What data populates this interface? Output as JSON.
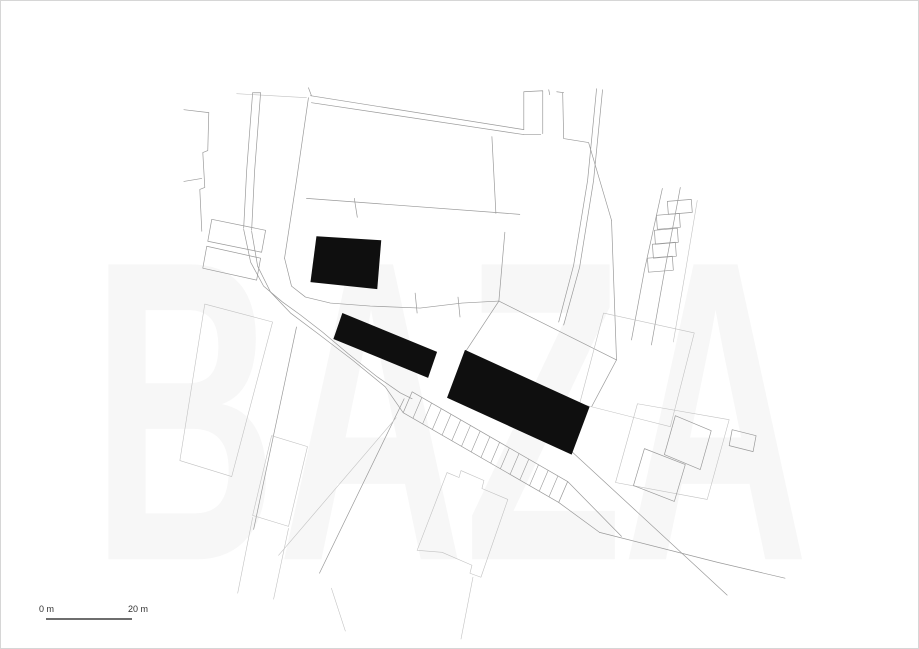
{
  "page": {
    "background": "#ffffff",
    "border_color": "#d6d6d6"
  },
  "watermark": {
    "text": "BAZA",
    "color": "#f7f7f7"
  },
  "scale_bar": {
    "start_label": "0 m",
    "end_label": "20 m",
    "line_color": "#6e6e6e",
    "text_color": "#333333"
  },
  "plan": {
    "canvas": {
      "width": 919,
      "height": 649
    },
    "colors": {
      "line_medium": "#9a9a9a",
      "line_light": "#c2c2c2",
      "building_fill": "#0f0f0f"
    },
    "buildings": [
      {
        "name": "building-footprint-top",
        "pts": [
          [
            316,
            236
          ],
          [
            381,
            240
          ],
          [
            377,
            289
          ],
          [
            310,
            282
          ]
        ]
      },
      {
        "name": "building-footprint-middle",
        "pts": [
          [
            342,
            313
          ],
          [
            437,
            352
          ],
          [
            428,
            378
          ],
          [
            333,
            339
          ]
        ]
      },
      {
        "name": "building-footprint-large",
        "pts": [
          [
            465,
            350
          ],
          [
            590,
            407
          ],
          [
            572,
            455
          ],
          [
            447,
            398
          ]
        ]
      }
    ],
    "parking_strip": {
      "outline": [
        [
          412,
          392
        ],
        [
          568,
          482
        ],
        [
          559,
          503
        ],
        [
          403,
          413
        ]
      ],
      "divider_count": 16
    },
    "polygons": [
      {
        "name": "small-parcel-1",
        "w": "m",
        "pts": [
          [
            211,
            219
          ],
          [
            265,
            230
          ],
          [
            261,
            252
          ],
          [
            207,
            241
          ]
        ]
      },
      {
        "name": "small-parcel-2",
        "w": "m",
        "pts": [
          [
            206,
            246
          ],
          [
            260,
            258
          ],
          [
            256,
            280
          ],
          [
            202,
            268
          ]
        ]
      },
      {
        "name": "garage-1",
        "w": "m",
        "pts": [
          [
            668,
            201
          ],
          [
            692,
            199
          ],
          [
            693,
            212
          ],
          [
            669,
            214
          ]
        ]
      },
      {
        "name": "garage-2",
        "w": "m",
        "pts": [
          [
            657,
            215
          ],
          [
            680,
            213
          ],
          [
            681,
            227
          ],
          [
            658,
            229
          ]
        ]
      },
      {
        "name": "garage-3",
        "w": "m",
        "pts": [
          [
            655,
            230
          ],
          [
            678,
            228
          ],
          [
            679,
            242
          ],
          [
            656,
            244
          ]
        ]
      },
      {
        "name": "garage-4",
        "w": "m",
        "pts": [
          [
            653,
            244
          ],
          [
            676,
            242
          ],
          [
            677,
            256
          ],
          [
            654,
            258
          ]
        ]
      },
      {
        "name": "garage-5",
        "w": "m",
        "pts": [
          [
            648,
            258
          ],
          [
            673,
            256
          ],
          [
            674,
            270
          ],
          [
            649,
            272
          ]
        ]
      },
      {
        "name": "west-parcel",
        "w": "l",
        "pts": [
          [
            204,
            304
          ],
          [
            272,
            322
          ],
          [
            231,
            477
          ],
          [
            179,
            461
          ]
        ]
      },
      {
        "name": "west-narrow-parcel",
        "w": "l",
        "pts": [
          [
            271,
            436
          ],
          [
            307,
            447
          ],
          [
            288,
            527
          ],
          [
            252,
            516
          ]
        ]
      },
      {
        "name": "southeast-parcel-1",
        "w": "l",
        "pts": [
          [
            604,
            313
          ],
          [
            695,
            333
          ],
          [
            671,
            427
          ],
          [
            580,
            404
          ]
        ]
      },
      {
        "name": "southeast-parcel-2",
        "w": "l",
        "pts": [
          [
            638,
            404
          ],
          [
            730,
            420
          ],
          [
            708,
            500
          ],
          [
            616,
            483
          ]
        ]
      },
      {
        "name": "southeast-inner-square-1",
        "w": "m",
        "pts": [
          [
            676,
            416
          ],
          [
            712,
            431
          ],
          [
            701,
            470
          ],
          [
            665,
            455
          ]
        ]
      },
      {
        "name": "southeast-inner-square-2",
        "w": "m",
        "pts": [
          [
            645,
            449
          ],
          [
            686,
            465
          ],
          [
            675,
            502
          ],
          [
            634,
            486
          ]
        ]
      },
      {
        "name": "southeast-appendage",
        "w": "m",
        "pts": [
          [
            733,
            430
          ],
          [
            757,
            436
          ],
          [
            754,
            452
          ],
          [
            730,
            446
          ]
        ]
      },
      {
        "name": "south-building-outline",
        "w": "l",
        "pts": [
          [
            447,
            473
          ],
          [
            459,
            478
          ],
          [
            461,
            471
          ],
          [
            484,
            481
          ],
          [
            482,
            489
          ],
          [
            508,
            500
          ],
          [
            481,
            578
          ],
          [
            470,
            574
          ],
          [
            472,
            566
          ],
          [
            442,
            553
          ],
          [
            417,
            551
          ]
        ]
      }
    ],
    "polylines": [
      {
        "name": "north-wall-band-top",
        "w": "m",
        "pts": [
          [
            310,
            95
          ],
          [
            524,
            129
          ]
        ]
      },
      {
        "name": "north-wall-band-bottom",
        "w": "m",
        "pts": [
          [
            311,
            102
          ],
          [
            524,
            134
          ]
        ]
      },
      {
        "name": "band-left-tick",
        "w": "m",
        "pts": [
          [
            308,
            87
          ],
          [
            311,
            95
          ]
        ]
      },
      {
        "name": "band-right-step",
        "w": "m",
        "pts": [
          [
            524,
            129
          ],
          [
            524,
            91
          ],
          [
            543,
            90
          ],
          [
            543,
            133
          ]
        ]
      },
      {
        "name": "band-bottom-stub",
        "w": "m",
        "pts": [
          [
            524,
            134
          ],
          [
            541,
            134
          ]
        ]
      },
      {
        "name": "band-tick-2",
        "w": "m",
        "pts": [
          [
            549,
            89
          ],
          [
            550,
            94
          ]
        ]
      },
      {
        "name": "band-tick-3",
        "w": "m",
        "pts": [
          [
            557,
            91
          ],
          [
            564,
            92
          ]
        ]
      },
      {
        "name": "band-right-outline",
        "w": "m",
        "pts": [
          [
            563,
            92
          ],
          [
            564,
            138
          ],
          [
            589,
            142
          ],
          [
            612,
            220
          ]
        ]
      },
      {
        "name": "parcel-east-edge",
        "w": "m",
        "pts": [
          [
            612,
            220
          ],
          [
            617,
            360
          ]
        ]
      },
      {
        "name": "top-connector",
        "w": "l",
        "pts": [
          [
            236,
            93
          ],
          [
            306,
            97
          ]
        ]
      },
      {
        "name": "parcel-divider",
        "w": "m",
        "pts": [
          [
            306,
            198
          ],
          [
            520,
            214
          ]
        ]
      },
      {
        "name": "parcel-vertical-divider",
        "w": "m",
        "pts": [
          [
            492,
            136
          ],
          [
            496,
            213
          ]
        ]
      },
      {
        "name": "parcel-vertical-tick",
        "w": "m",
        "pts": [
          [
            354,
            198
          ],
          [
            357,
            217
          ]
        ]
      },
      {
        "name": "west-jagged-edge",
        "w": "m",
        "pts": [
          [
            208,
            112
          ],
          [
            207,
            150
          ],
          [
            202,
            152
          ],
          [
            204,
            187
          ],
          [
            199,
            189
          ],
          [
            201,
            231
          ]
        ]
      },
      {
        "name": "west-stub-1",
        "w": "m",
        "pts": [
          [
            183,
            109
          ],
          [
            208,
            112
          ]
        ]
      },
      {
        "name": "west-stub-2",
        "w": "m",
        "pts": [
          [
            183,
            181
          ],
          [
            201,
            178
          ]
        ]
      },
      {
        "name": "west-road-line-1",
        "w": "m",
        "pts": [
          [
            252,
            92
          ],
          [
            246,
            170
          ],
          [
            243,
            228
          ]
        ]
      },
      {
        "name": "west-road-line-2",
        "w": "m",
        "pts": [
          [
            260,
            92
          ],
          [
            254,
            170
          ],
          [
            251,
            230
          ]
        ]
      },
      {
        "name": "west-road-top-tick",
        "w": "m",
        "pts": [
          [
            252,
            92
          ],
          [
            260,
            92
          ]
        ]
      },
      {
        "name": "street-outer-edge",
        "w": "m",
        "pts": [
          [
            251,
            231
          ],
          [
            257,
            266
          ],
          [
            270,
            292
          ],
          [
            290,
            313
          ],
          [
            318,
            334
          ],
          [
            352,
            360
          ],
          [
            385,
            387
          ],
          [
            403,
            413
          ]
        ]
      },
      {
        "name": "street-inner-edge",
        "w": "m",
        "pts": [
          [
            243,
            229
          ],
          [
            250,
            262
          ],
          [
            263,
            286
          ],
          [
            282,
            302
          ],
          [
            300,
            315
          ],
          [
            322,
            332
          ],
          [
            348,
            354
          ],
          [
            377,
            377
          ],
          [
            400,
            393
          ],
          [
            412,
            399
          ]
        ]
      },
      {
        "name": "parcel-left-edge",
        "w": "m",
        "pts": [
          [
            308,
            97
          ],
          [
            296,
            180
          ],
          [
            284,
            258
          ]
        ]
      },
      {
        "name": "sidewalk-boundary",
        "w": "m",
        "pts": [
          [
            284,
            258
          ],
          [
            291,
            286
          ],
          [
            305,
            297
          ],
          [
            330,
            303
          ],
          [
            370,
            306
          ],
          [
            420,
            308
          ],
          [
            462,
            303
          ],
          [
            499,
            301
          ]
        ]
      },
      {
        "name": "sidewalk-tick-1",
        "w": "m",
        "pts": [
          [
            415,
            293
          ],
          [
            417,
            313
          ]
        ]
      },
      {
        "name": "sidewalk-tick-2",
        "w": "m",
        "pts": [
          [
            458,
            297
          ],
          [
            460,
            317
          ]
        ]
      },
      {
        "name": "pentagon-left-edge",
        "w": "m",
        "pts": [
          [
            505,
            232
          ],
          [
            499,
            301
          ]
        ]
      },
      {
        "name": "pentagon-northeast-edge",
        "w": "m",
        "pts": [
          [
            499,
            301
          ],
          [
            617,
            360
          ]
        ]
      },
      {
        "name": "pentagon-east-edge",
        "w": "m",
        "pts": [
          [
            617,
            360
          ],
          [
            592,
            407
          ]
        ]
      },
      {
        "name": "pentagon-west-edge",
        "w": "m",
        "pts": [
          [
            499,
            301
          ],
          [
            466,
            351
          ]
        ]
      },
      {
        "name": "east-road-line-1",
        "w": "m",
        "pts": [
          [
            597,
            88
          ],
          [
            588,
            180
          ],
          [
            574,
            265
          ],
          [
            559,
            322
          ]
        ]
      },
      {
        "name": "east-road-line-2",
        "w": "m",
        "pts": [
          [
            603,
            89
          ],
          [
            594,
            180
          ],
          [
            580,
            267
          ],
          [
            564,
            325
          ]
        ]
      },
      {
        "name": "northeast-v-line-1",
        "w": "m",
        "pts": [
          [
            663,
            188
          ],
          [
            645,
            270
          ],
          [
            632,
            340
          ]
        ]
      },
      {
        "name": "northeast-v-line-2",
        "w": "m",
        "pts": [
          [
            681,
            187
          ],
          [
            665,
            272
          ],
          [
            652,
            345
          ]
        ]
      },
      {
        "name": "northeast-v-line-3",
        "w": "l",
        "pts": [
          [
            698,
            200
          ],
          [
            686,
            272
          ],
          [
            674,
            342
          ]
        ]
      },
      {
        "name": "south-road-line-1",
        "w": "m",
        "pts": [
          [
            404,
            399
          ],
          [
            319,
            574
          ]
        ]
      },
      {
        "name": "south-road-line-2",
        "w": "l",
        "pts": [
          [
            396,
            418
          ],
          [
            278,
            556
          ]
        ]
      },
      {
        "name": "west-road-south",
        "w": "m",
        "pts": [
          [
            296,
            327
          ],
          [
            253,
            530
          ]
        ]
      },
      {
        "name": "west-road-tail-1",
        "w": "l",
        "pts": [
          [
            252,
            518
          ],
          [
            237,
            594
          ]
        ]
      },
      {
        "name": "west-road-tail-2",
        "w": "l",
        "pts": [
          [
            288,
            529
          ],
          [
            273,
            600
          ]
        ]
      },
      {
        "name": "strip-continuation-1",
        "w": "m",
        "pts": [
          [
            568,
            482
          ],
          [
            622,
            537
          ]
        ]
      },
      {
        "name": "strip-continuation-2",
        "w": "m",
        "pts": [
          [
            559,
            503
          ],
          [
            600,
            533
          ]
        ]
      },
      {
        "name": "southeast-road-1",
        "w": "m",
        "pts": [
          [
            570,
            450
          ],
          [
            700,
            570
          ],
          [
            728,
            596
          ]
        ]
      },
      {
        "name": "southeast-road-2",
        "w": "m",
        "pts": [
          [
            600,
            533
          ],
          [
            718,
            563
          ],
          [
            786,
            579
          ]
        ]
      },
      {
        "name": "south-building-tail",
        "w": "l",
        "pts": [
          [
            473,
            578
          ],
          [
            461,
            640
          ]
        ]
      },
      {
        "name": "southwest-short-line",
        "w": "l",
        "pts": [
          [
            331,
            589
          ],
          [
            345,
            632
          ]
        ]
      }
    ]
  }
}
